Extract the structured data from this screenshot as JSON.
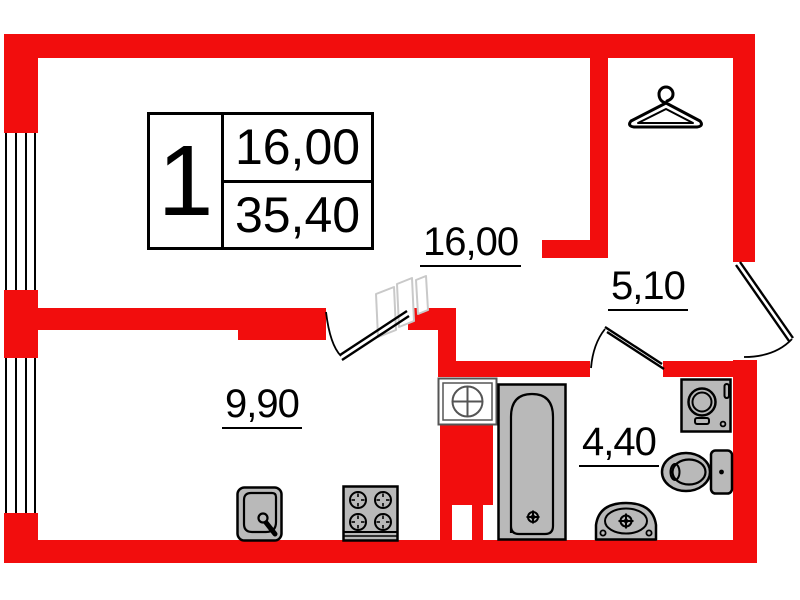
{
  "title_block": {
    "room_count": "1",
    "living_area": "16,00",
    "total_area": "35,40"
  },
  "rooms": [
    {
      "name": "living-room",
      "area_label": "16,00"
    },
    {
      "name": "hallway",
      "area_label": "5,10"
    },
    {
      "name": "kitchen",
      "area_label": "9,90"
    },
    {
      "name": "bathroom",
      "area_label": "4,40"
    }
  ],
  "icons": {
    "hanger": "clothes-hanger-icon",
    "vent": "ventilation-shaft-icon",
    "bathtub": "bathtub-icon",
    "washing_machine": "washing-machine-icon",
    "toilet": "toilet-icon",
    "pedestal_sink": "pedestal-sink-icon",
    "kitchen_sink": "kitchen-sink-icon",
    "stove": "stove-4-burner-icon"
  },
  "colors": {
    "wall_red": "#f20d0d",
    "fixture_gray": "#b9b9b9",
    "line_black": "#000000",
    "ghost_gray": "#c9c9c9"
  }
}
